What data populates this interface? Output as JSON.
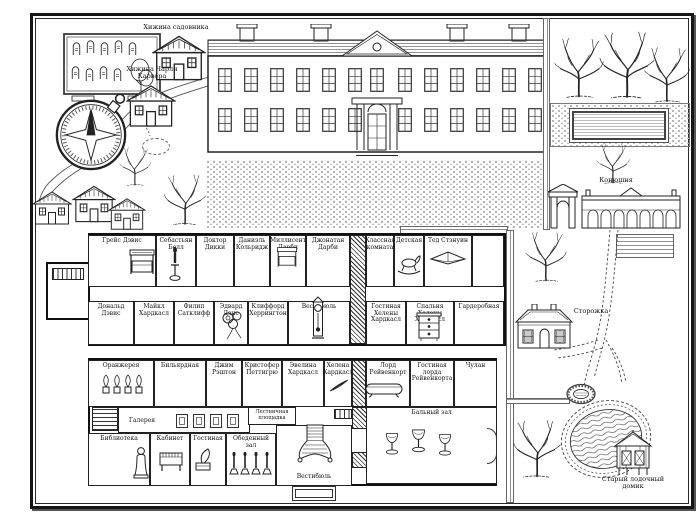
{
  "colors": {
    "ink": "#1a1a1a",
    "paper": "#ffffff"
  },
  "grounds": {
    "gardener_hut_label": "Хижина садовника",
    "carver_hut_label": "Хижина Чарли Карвера",
    "stables_label": "Конюшня",
    "lodge_label": "Сторожка",
    "boathouse_label": "Старый лодочный домик"
  },
  "first_floor": {
    "top_rooms": [
      {
        "label": "Грейс Дэвис"
      },
      {
        "label": "Себастьян Белл"
      },
      {
        "label": "Доктор Дикки"
      },
      {
        "label": "Даниэль Кольридж"
      },
      {
        "label": "Миллисент Дарби"
      },
      {
        "label": "Джонатан Дарби"
      },
      {
        "label": "Классная комната"
      },
      {
        "label": "Детская"
      },
      {
        "label": "Тед Стэнуин"
      }
    ],
    "bottom_rooms": [
      {
        "label": "Дональд Дэвис"
      },
      {
        "label": "Майкл Хардкасл"
      },
      {
        "label": "Филип Сатклифф"
      },
      {
        "label": "Эдвард Дэнс"
      },
      {
        "label": "Клиффорд Херрингтон"
      },
      {
        "label": "Вестибюль"
      },
      {
        "label": "Гостиная Хелены Хардкасл"
      },
      {
        "label": "Спальня Хелены Хардкасл"
      },
      {
        "label": "Гардеробная"
      }
    ]
  },
  "ground_floor": {
    "top_rooms": [
      {
        "label": "Оранжерея"
      },
      {
        "label": "Бильярдная"
      },
      {
        "label": "Джим Рэштон"
      },
      {
        "label": "Кристофер Петтигрю"
      },
      {
        "label": "Эвелина Хардкасл"
      },
      {
        "label": "Хелена Хардкасл"
      },
      {
        "label": "Лорд Рейвенкорт"
      },
      {
        "label": "Гостиная лорда Рейвенкорта"
      },
      {
        "label": "Чулан"
      }
    ],
    "bottom_rooms": [
      {
        "label": "Библиотека"
      },
      {
        "label": "Галерея"
      },
      {
        "label": "Кабинет"
      },
      {
        "label": "Гостиная"
      },
      {
        "label": "Обеденный зал"
      },
      {
        "label": "Лестничная площадка"
      },
      {
        "label": "Вестибюль"
      },
      {
        "label": "Бальный зал"
      }
    ]
  }
}
